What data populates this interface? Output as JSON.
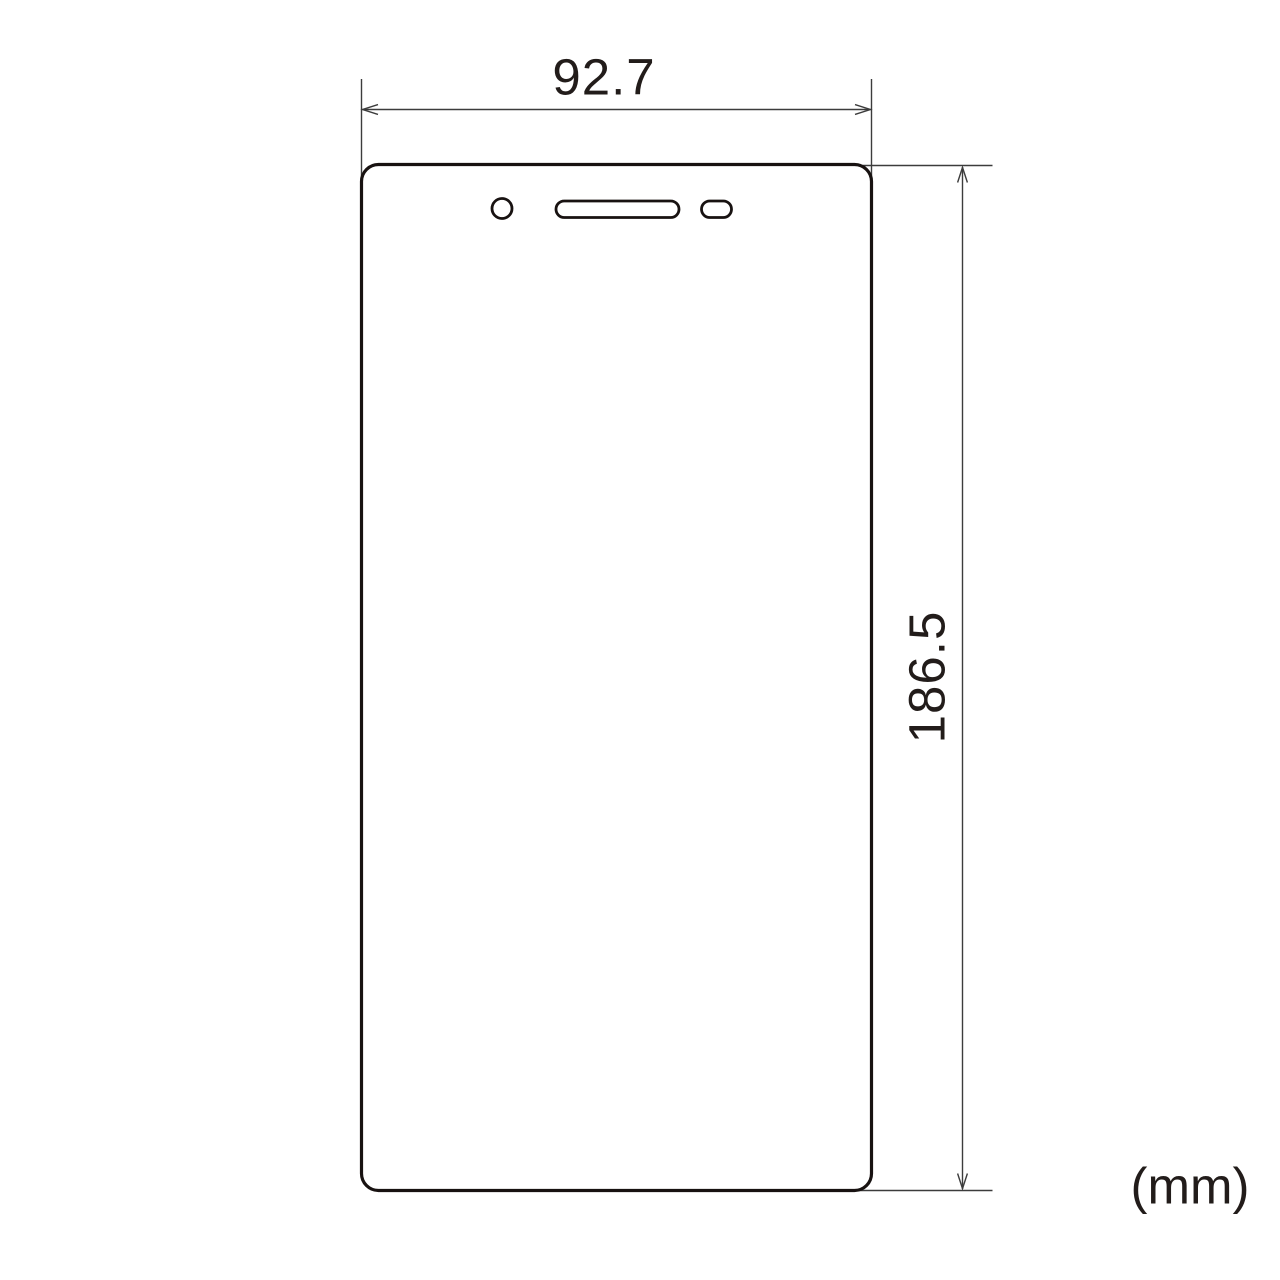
{
  "figure": {
    "unit_label": "(mm)"
  },
  "dimensions": {
    "width_mm": "92.7",
    "height_mm": "186.5"
  },
  "colors": {
    "background": "#ffffff",
    "outline_ink": "#181211",
    "dimension_line": "#3c3c3c",
    "text_ink": "#221c1a"
  },
  "shapes": {
    "device_outline": "rounded-rect-screen-protector",
    "cutouts": [
      "camera-hole",
      "earpiece-speaker-slot",
      "sensor-pill"
    ]
  }
}
